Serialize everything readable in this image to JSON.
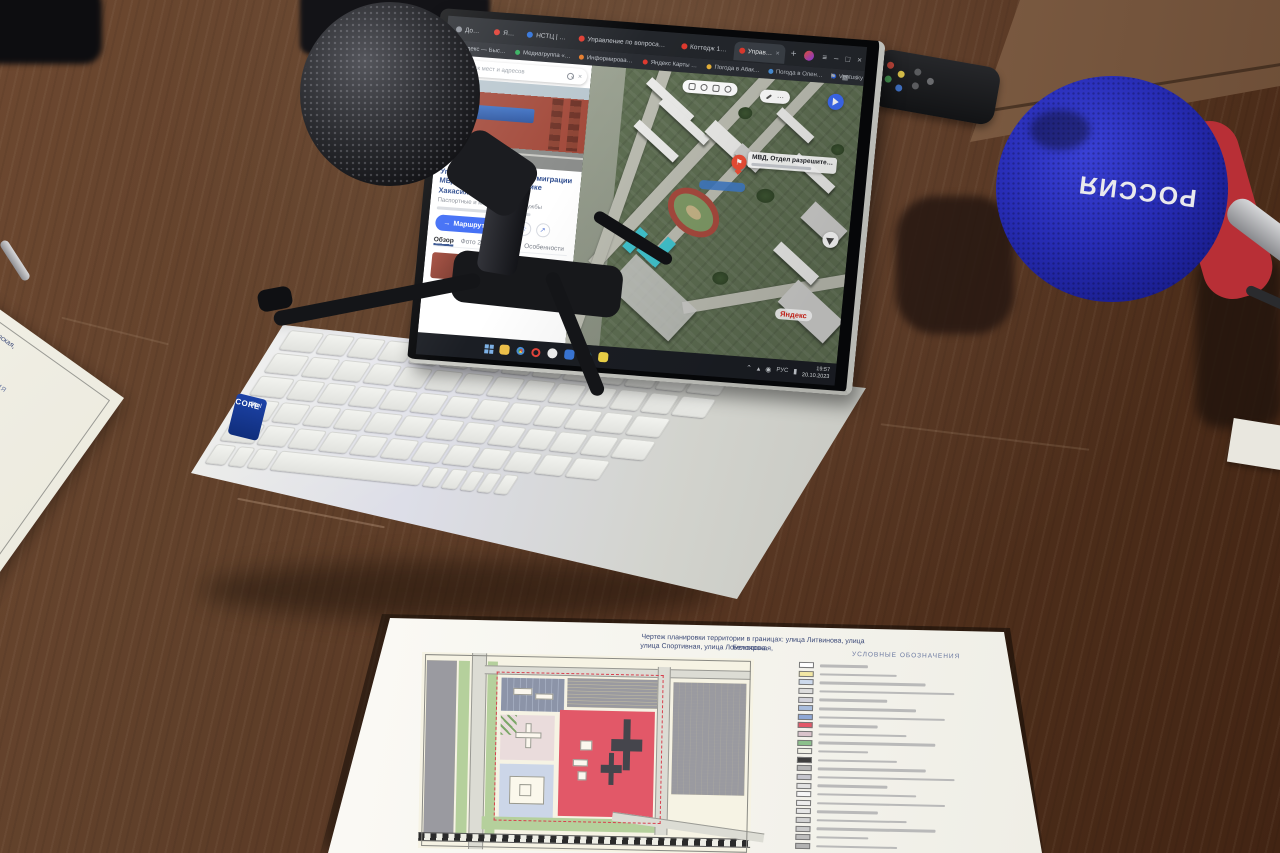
{
  "browser": {
    "tabs": [
      {
        "label": "Дом — Тан…",
        "color": "#8a8f98",
        "active": false,
        "close": false
      },
      {
        "label": "Яндекс",
        "color": "#e03a2f",
        "active": false,
        "close": false
      },
      {
        "label": "НСТЦ | Геоинформ…",
        "color": "#2b6fd9",
        "active": false,
        "close": false
      },
      {
        "label": "Управление по вопросам миграции МВД России по Республике Хакасия — Яндекс Ка…",
        "color": "#e03a2f",
        "active": false,
        "close": false
      },
      {
        "label": "Коттедж 180 м² из руч…",
        "color": "#e03a2f",
        "active": false,
        "close": false
      },
      {
        "label": "Управление по вопр…",
        "color": "#e03a2f",
        "active": true,
        "close": true
      }
    ],
    "new_tab": "+",
    "bookmarks": [
      {
        "label": "Яндекс — Быстр…",
        "color": "#e03a2f"
      },
      {
        "label": "Медиагруппа «Ю…",
        "color": "#2fae5a"
      },
      {
        "label": "Информирование…",
        "color": "#e57b2a"
      },
      {
        "label": "Яндекс Карты —…",
        "color": "#e03a2f"
      },
      {
        "label": "Погода в Абак…",
        "color": "#e8b23a"
      },
      {
        "label": "Погода в Олен…",
        "color": "#4a90d9"
      },
      {
        "label": "Ventusky",
        "color": "#2b5fd9"
      }
    ]
  },
  "maps": {
    "search_placeholder": "Поиск мест и адресов",
    "place": {
      "title": "Управление по вопросам миграции МВД России по Республике Хакасия",
      "category": "Паспортные и миграционные службы",
      "route_button": "Маршрут",
      "tabs": [
        "Обзор",
        "Фото 2",
        "Отзывы 2",
        "Особенности",
        "Похожие"
      ]
    },
    "pin_label": "МВД, Отдел разрешите…",
    "logo": "Яндекс"
  },
  "taskbar": {
    "lang": "РУС",
    "time": "19:57",
    "date": "20.10.2023",
    "apps": [
      {
        "name": "folder-icon",
        "type": "sq",
        "color": "#f0c24a"
      },
      {
        "name": "chrome-icon",
        "type": "chrome",
        "color": ""
      },
      {
        "name": "opera-icon",
        "type": "ring",
        "color": "#e8453c"
      },
      {
        "name": "app-white-icon",
        "type": "dot",
        "color": "#f2f2f2"
      },
      {
        "name": "word-icon",
        "type": "sq",
        "color": "#3a78d9"
      },
      {
        "name": "edge-icon",
        "type": "dot",
        "color": "#35b3d9"
      },
      {
        "name": "notes-icon",
        "type": "sq",
        "color": "#f5d949"
      }
    ]
  },
  "laptop": {
    "sticker_top": "intel",
    "sticker_mid": "CORE",
    "sticker_bot": "i7"
  },
  "microphone": {
    "brand": "РОССИЯ"
  },
  "papers": {
    "front": {
      "title_line1": "Чертеж планировки территории в границах: улица Литвинова, улица Белоярская,",
      "title_line2": "улица Спортивная, улица Ломоносова.",
      "legend_title": "УСЛОВНЫЕ ОБОЗНАЧЕНИЯ",
      "legend_colors": [
        "#ffffff",
        "#f2e7a4",
        "#ccd9ec",
        "#dddddd",
        "#d2d2da",
        "#a9bddd",
        "#8fa8d6",
        "#e25868",
        "#d9c3cb",
        "#8cc08c",
        "#f0f0e6",
        "#3e3e3e",
        "#b5b5b5",
        "#c5c5cd",
        "#e2e2e2",
        "#f6f6f6",
        "#ededed",
        "#e6e6e6",
        "#d2d2d2",
        "#cacaca",
        "#bebebe",
        "#b2b2b2"
      ]
    }
  }
}
